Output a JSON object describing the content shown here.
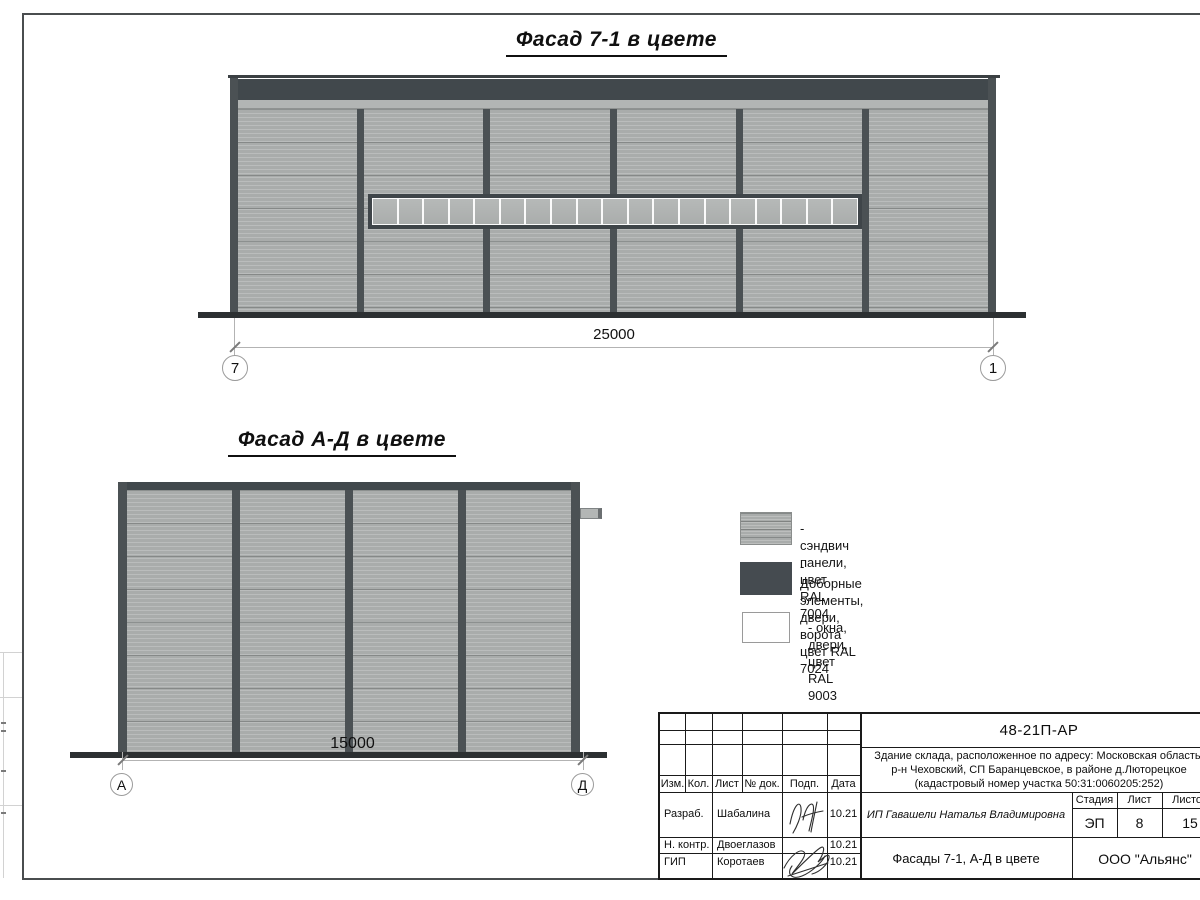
{
  "drawing": {
    "facade_71": {
      "title": "Фасад 7-1 в цвете",
      "bays": 6,
      "window_panes": 19,
      "dimension": "25000",
      "axis_left": "7",
      "axis_right": "1"
    },
    "facade_ad": {
      "title": "Фасад А-Д в цвете",
      "bays": 4,
      "dimension": "15000",
      "axis_left": "А",
      "axis_right": "Д"
    }
  },
  "legend": {
    "items": [
      {
        "label": "- сэндвич панели, цвет RAL 7004"
      },
      {
        "label": "- Доборные элементы, двери, ворота\nцвет RAL 7024"
      },
      {
        "label": "- окна, двери, цвет RAL 9003"
      }
    ]
  },
  "colors": {
    "sandwich_panel_ral7004": "#a9acab",
    "dark_elements_ral7024": "#41484c",
    "windows_ral9003": "#ffffff"
  },
  "title_block": {
    "doc_number": "48-21П-АР",
    "project_description": "Здание склада, расположенное по адресу: Московская область,\nр-н Чеховский, СП Баранцевское, в районе д.Люторецкое\n(кадастровый номер участка 50:31:0060205:252)",
    "revision_columns": [
      "Изм.",
      "Кол.",
      "Лист",
      "№ док.",
      "Подп.",
      "Дата"
    ],
    "stage_label": "Стадия",
    "sheet_label": "Лист",
    "sheets_label": "Листов",
    "stage_value": "ЭП",
    "sheet_value": "8",
    "sheets_value": "15",
    "client": "ИП Гавашели Наталья Владимировна",
    "sheet_title": "Фасады 7-1, А-Д в цвете",
    "company": "ООО \"Альянс\"",
    "signature_rows": [
      {
        "role": "Разраб.",
        "name": "Шабалина",
        "date": "10.21"
      },
      {
        "role": "Н. контр.",
        "name": "Двоеглазов",
        "date": "10.21"
      },
      {
        "role": "ГИП",
        "name": "Коротаев",
        "date": "10.21"
      }
    ]
  }
}
